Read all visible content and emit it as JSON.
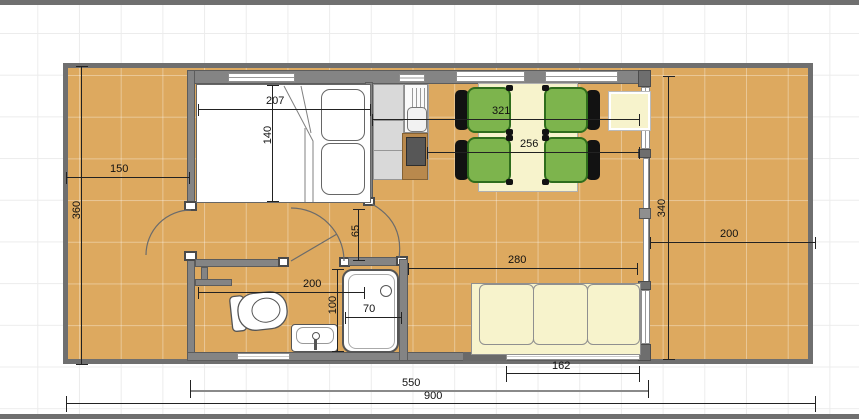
{
  "plan": {
    "title": "cabin-floor-plan",
    "dimensions": {
      "deck_left_width": "150",
      "site_depth": "360",
      "bed_width": "207",
      "bed_depth": "140",
      "living_span_upper": "321",
      "living_span_lower": "256",
      "house_depth": "340",
      "deck_right_width": "200",
      "passage_width": "65",
      "bath_width": "200",
      "bath_depth": "100",
      "tub_width": "70",
      "lounge_width": "280",
      "rear_window_width": "162",
      "house_width": "550",
      "site_width": "900"
    },
    "furniture": {
      "bed": "double-bed",
      "kitchen": "kitchen-counter-sink-stove",
      "dining": "table-with-four-chairs",
      "side_table": "side-table",
      "sofa": "three-seat-sofa",
      "bathroom": "toilet-sink-bathtub"
    },
    "colors": {
      "deck": "#dda95f",
      "wall": "#848484",
      "chair_green": "#7db44d",
      "upholstery_cream": "#f7f3cc",
      "fixture_white": "#ffffff",
      "dimension_text": "#111111"
    }
  }
}
